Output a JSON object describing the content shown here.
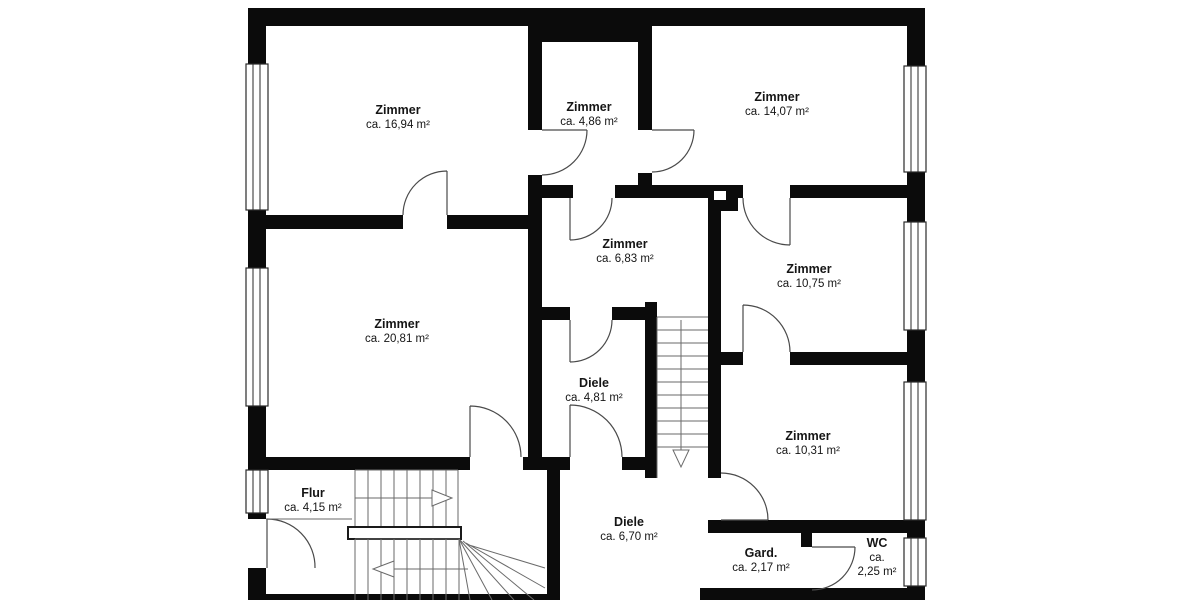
{
  "plan": {
    "wall_color": "#0b0b0b",
    "line_color": "#4a4a4a",
    "rooms": [
      {
        "id": "zimmer-1694",
        "name": "Zimmer",
        "area": "ca. 16,94 m²"
      },
      {
        "id": "zimmer-486",
        "name": "Zimmer",
        "area": "ca. 4,86 m²"
      },
      {
        "id": "zimmer-1407",
        "name": "Zimmer",
        "area": "ca. 14,07 m²"
      },
      {
        "id": "zimmer-683",
        "name": "Zimmer",
        "area": "ca. 6,83 m²"
      },
      {
        "id": "zimmer-1075",
        "name": "Zimmer",
        "area": "ca. 10,75 m²"
      },
      {
        "id": "zimmer-2081",
        "name": "Zimmer",
        "area": "ca. 20,81 m²"
      },
      {
        "id": "diele-481",
        "name": "Diele",
        "area": "ca. 4,81 m²"
      },
      {
        "id": "zimmer-1031",
        "name": "Zimmer",
        "area": "ca. 10,31 m²"
      },
      {
        "id": "flur-415",
        "name": "Flur",
        "area": "ca. 4,15 m²"
      },
      {
        "id": "diele-670",
        "name": "Diele",
        "area": "ca. 6,70 m²"
      },
      {
        "id": "gard-217",
        "name": "Gard.",
        "area": "ca. 2,17 m²"
      },
      {
        "id": "wc-225",
        "name": "WC",
        "area": "ca.",
        "area2": "2,25 m²"
      }
    ]
  }
}
